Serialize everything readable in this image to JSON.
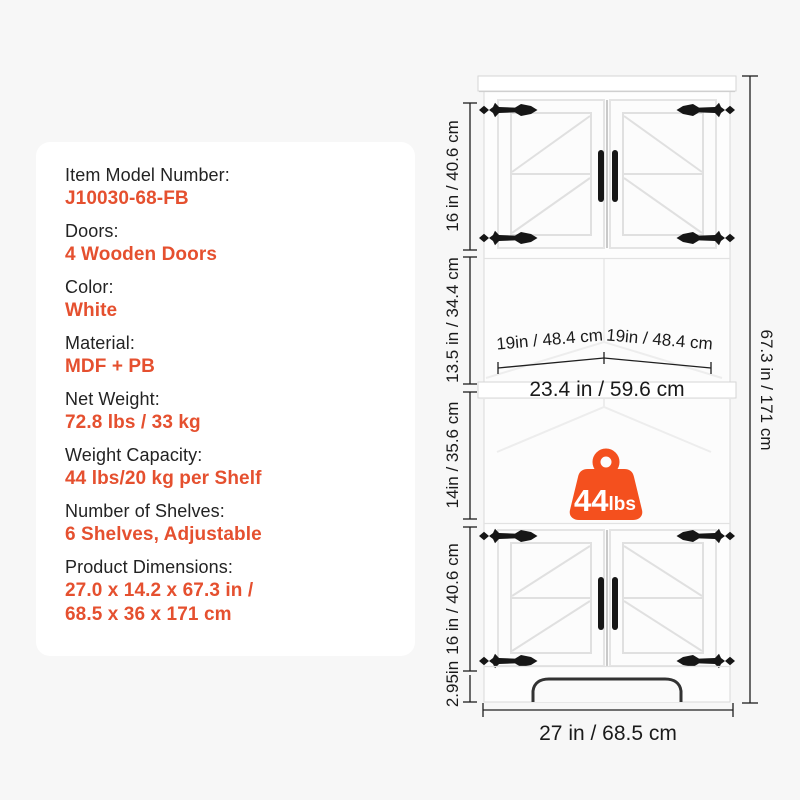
{
  "colors": {
    "background": "#f7f7f7",
    "card_bg": "#ffffff",
    "accent_text": "#e5502f",
    "weight_icon": "#f4501e",
    "dim_line": "#1f1f1f",
    "hardware_black": "#161616"
  },
  "spec_card": {
    "items": [
      {
        "label": "Item Model Number:",
        "value": "J10030-68-FB"
      },
      {
        "label": "Doors:",
        "value": "4 Wooden Doors"
      },
      {
        "label": "Color:",
        "value": "White"
      },
      {
        "label": "Material:",
        "value": "MDF + PB"
      },
      {
        "label": "Net Weight:",
        "value": "72.8 lbs / 33 kg"
      },
      {
        "label": "Weight Capacity:",
        "value": "44 lbs/20 kg per Shelf"
      },
      {
        "label": "Number of Shelves:",
        "value": "6 Shelves, Adjustable"
      },
      {
        "label": "Product Dimensions:",
        "value": "27.0 x 14.2 x 67.3 in /",
        "value2": "68.5 x 36 x 171 cm"
      }
    ]
  },
  "diagram": {
    "dims": {
      "top_section": "16 in / 40.6 cm",
      "second_section": "13.5 in / 34.4 cm",
      "third_section": "14in / 35.6 cm",
      "fourth_section": "16 in / 40.6 cm",
      "base_height": "2.95in",
      "total_height": "67.3 in / 171 cm",
      "shelf_side_left": "19in / 48.4 cm",
      "shelf_side_right": "19in / 48.4 cm",
      "shelf_front_width": "23.4 in / 59.6 cm",
      "overall_width": "27 in / 68.5 cm"
    },
    "weight_badge": {
      "number": "44",
      "unit": "lbs"
    }
  }
}
